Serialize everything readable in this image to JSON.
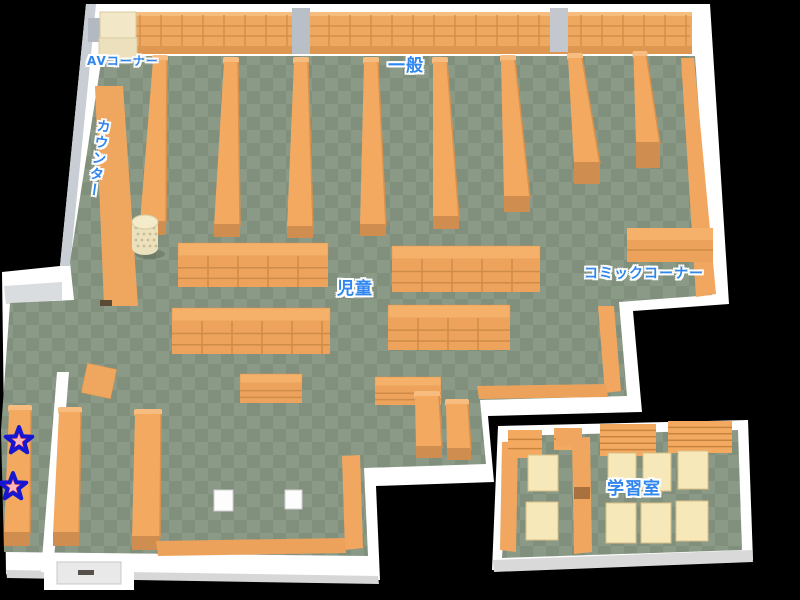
{
  "background": "#000000",
  "map": {
    "areas": [
      {
        "id": "av-corner",
        "label": "AVコーナー"
      },
      {
        "id": "counter",
        "label": "カウンター"
      },
      {
        "id": "general",
        "label": "一般"
      },
      {
        "id": "children",
        "label": "児童"
      },
      {
        "id": "comic-corner",
        "label": "コミックコーナー"
      },
      {
        "id": "study-room",
        "label": "学習室"
      }
    ],
    "markers": [
      {
        "id": "star-1",
        "icon": "star-marker-icon",
        "fill": "#ee4444",
        "outline": "#1717d1",
        "inner": "#ffb9b9"
      },
      {
        "id": "star-2",
        "icon": "star-marker-icon",
        "fill": "#ee4444",
        "outline": "#1717d1",
        "inner": "#ffb9b9"
      }
    ],
    "palette": {
      "floor_light": "#8b9a87",
      "floor_dark": "#818f7d",
      "shelf": "#f3aa60",
      "shelf_front": "#eda35c",
      "shelf_line": "#cf8b48",
      "shelf_base": "#cf8d4f",
      "shelf_cap": "#f7bd80",
      "wall": "#ffffff",
      "wall_shade": "#c9ced4",
      "av_unit": "#f2e7c7",
      "desk": "#f6e8b8",
      "label_text": "#2f86ef"
    }
  }
}
